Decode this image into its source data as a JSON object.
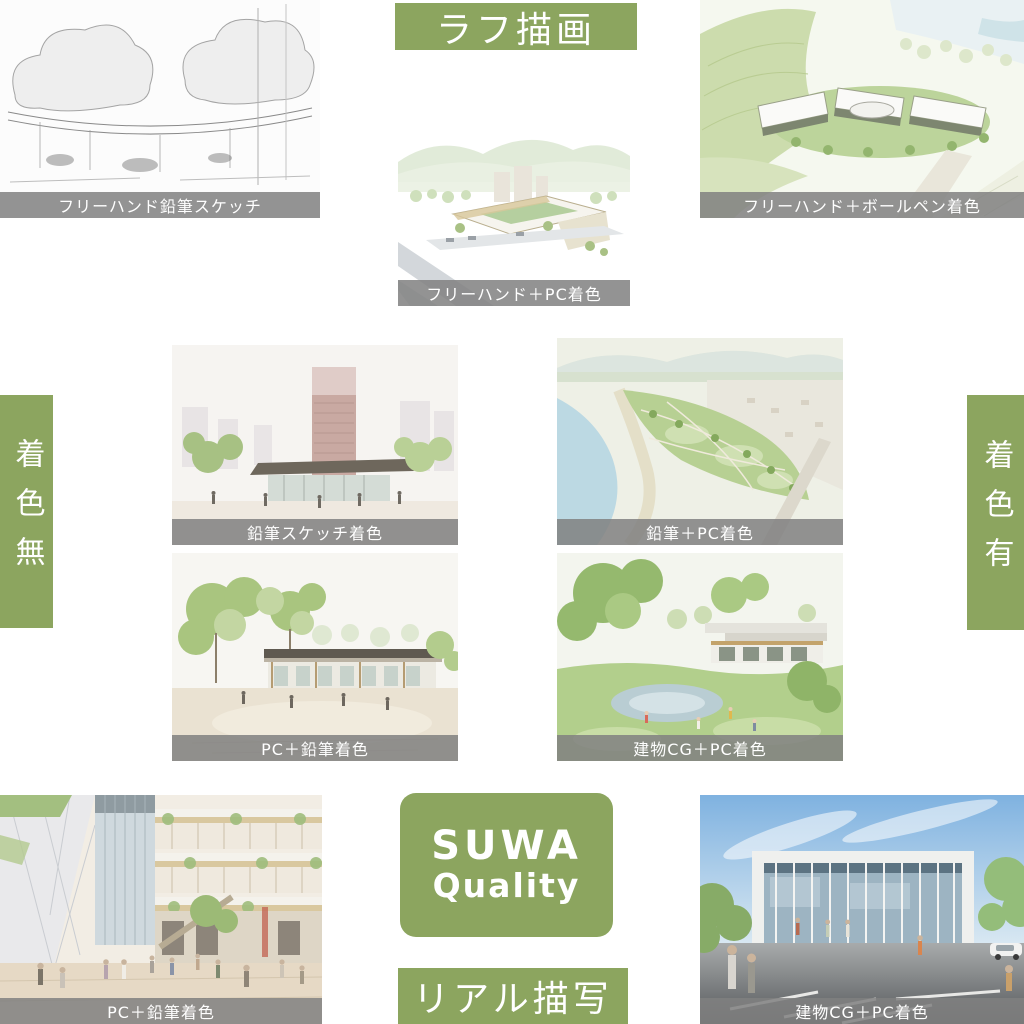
{
  "canvas": {
    "width": 1024,
    "height": 1024,
    "background": "#ffffff"
  },
  "colors": {
    "accent_green": "#8CA55F",
    "caption_bar_gray": "#8C8C8C",
    "caption_text": "#ffffff",
    "label_text": "#ffffff"
  },
  "axes": {
    "top": "ラフ描画",
    "bottom": "リアル描写",
    "left": "着色無",
    "right": "着色有"
  },
  "badge": {
    "line1": "SUWA",
    "line2": "Quality"
  },
  "panels": [
    {
      "caption": "フリーハンド鉛筆スケッチ",
      "scene": "grayscale freehand pencil sketch of trees and a long canopy structure"
    },
    {
      "caption": "フリーハンド＋PC着色",
      "scene": "soft watercolor aerial of a courtyard building with mountains behind"
    },
    {
      "caption": "フリーハンド＋ボールペン着色",
      "scene": "ballpoint and watercolor aerial of white buildings in green terraced hills"
    },
    {
      "caption": "鉛筆スケッチ着色",
      "scene": "colored pencil sketch of a park pavilion with a high-rise tower behind"
    },
    {
      "caption": "鉛筆＋PC着色",
      "scene": "aerial view of riverside park with blue river and green fields"
    },
    {
      "caption": "PC＋鉛筆着色",
      "scene": "low wooden building in a tree-lined plaza"
    },
    {
      "caption": "建物CG＋PC着色",
      "scene": "building CG composited into green lawn with pond and large trees"
    },
    {
      "caption": "PC＋鉛筆着色",
      "scene": "street-level view of a multi-story shopping plaza with many people"
    },
    {
      "caption": "建物CG＋PC着色",
      "scene": "photoreal CG of a glass-front building with blue sky and parking lot"
    }
  ]
}
